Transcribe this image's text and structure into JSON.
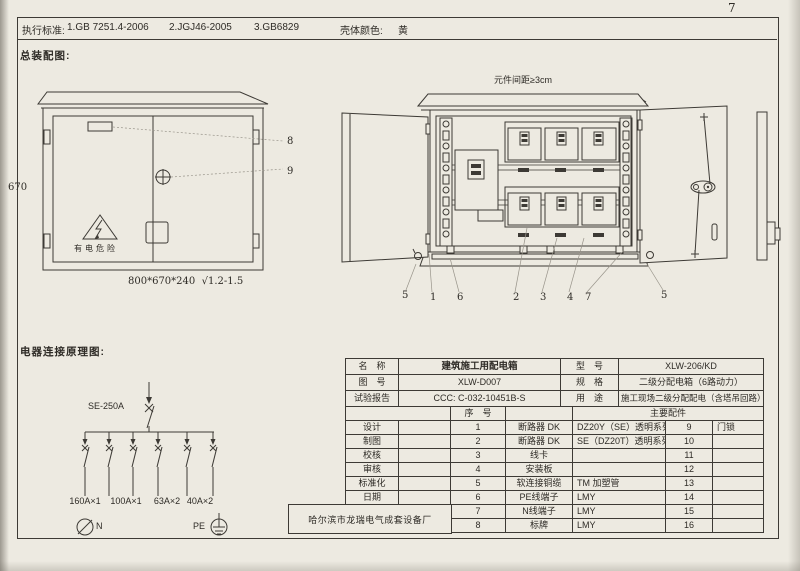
{
  "page": {
    "number": "7"
  },
  "top_bar": {
    "standards_label": "执行标准:",
    "standard_1": "1.GB 7251.4-2006",
    "standard_2": "2.JGJ46-2005",
    "standard_3": "3.GB6829",
    "shell_color_label": "壳体颜色:",
    "shell_color_value": "黄"
  },
  "assembly": {
    "section_title": "总装配图:",
    "height_dim": "670",
    "size_note": "800*670*240  √1.2-1.5",
    "warning_text": "有电危险",
    "spacing_note": "元件间距≥3cm",
    "callouts": [
      "8",
      "9",
      "5",
      "1",
      "6",
      "2",
      "3",
      "4",
      "7",
      "5"
    ]
  },
  "schematic": {
    "section_title": "电器连接原理图:",
    "main_breaker_label": "SE-250A",
    "branch_labels": [
      "160A×1",
      "100A×1",
      "63A×2",
      "40A×2"
    ],
    "neutral_label": "N",
    "pe_label": "PE"
  },
  "spec_table": {
    "name_label": "名　称",
    "name_value": "建筑施工用配电箱",
    "model_label": "型　号",
    "model_value": "XLW-206/KD",
    "drawing_no_label": "图　号",
    "drawing_no_value": "XLW-D007",
    "spec_label": "规　格",
    "spec_value": "二级分配电箱（6路动力）",
    "test_report_label": "试验报告",
    "test_report_value": "CCC: C-032-10451B-S",
    "usage_label": "用　途",
    "usage_value": "施工现场二级分配配电（含塔吊回路）",
    "seq_header": "序　号",
    "parts_header": "主要配件",
    "sign_labels": [
      "设计",
      "制图",
      "校核",
      "审核",
      "标准化",
      "日期"
    ],
    "company": "哈尔滨市龙瑞电气成套设备厂",
    "rows": [
      {
        "no": "1",
        "name": "断路器 DK",
        "spec": "DZ20Y（SE）透明系列",
        "no2": "9",
        "name2": "门锁"
      },
      {
        "no": "2",
        "name": "断路器 DK",
        "spec": "SE（DZ20T）透明系列",
        "no2": "10",
        "name2": ""
      },
      {
        "no": "3",
        "name": "线卡",
        "spec": "",
        "no2": "11",
        "name2": ""
      },
      {
        "no": "4",
        "name": "安装板",
        "spec": "",
        "no2": "12",
        "name2": ""
      },
      {
        "no": "5",
        "name": "软连接铜缆",
        "spec": "TM 加塑管",
        "no2": "13",
        "name2": ""
      },
      {
        "no": "6",
        "name": "PE线端子",
        "spec": "LMY",
        "no2": "14",
        "name2": ""
      },
      {
        "no": "7",
        "name": "N线端子",
        "spec": "LMY",
        "no2": "15",
        "name2": ""
      },
      {
        "no": "8",
        "name": "标牌",
        "spec": "LMY",
        "no2": "16",
        "name2": ""
      }
    ]
  }
}
